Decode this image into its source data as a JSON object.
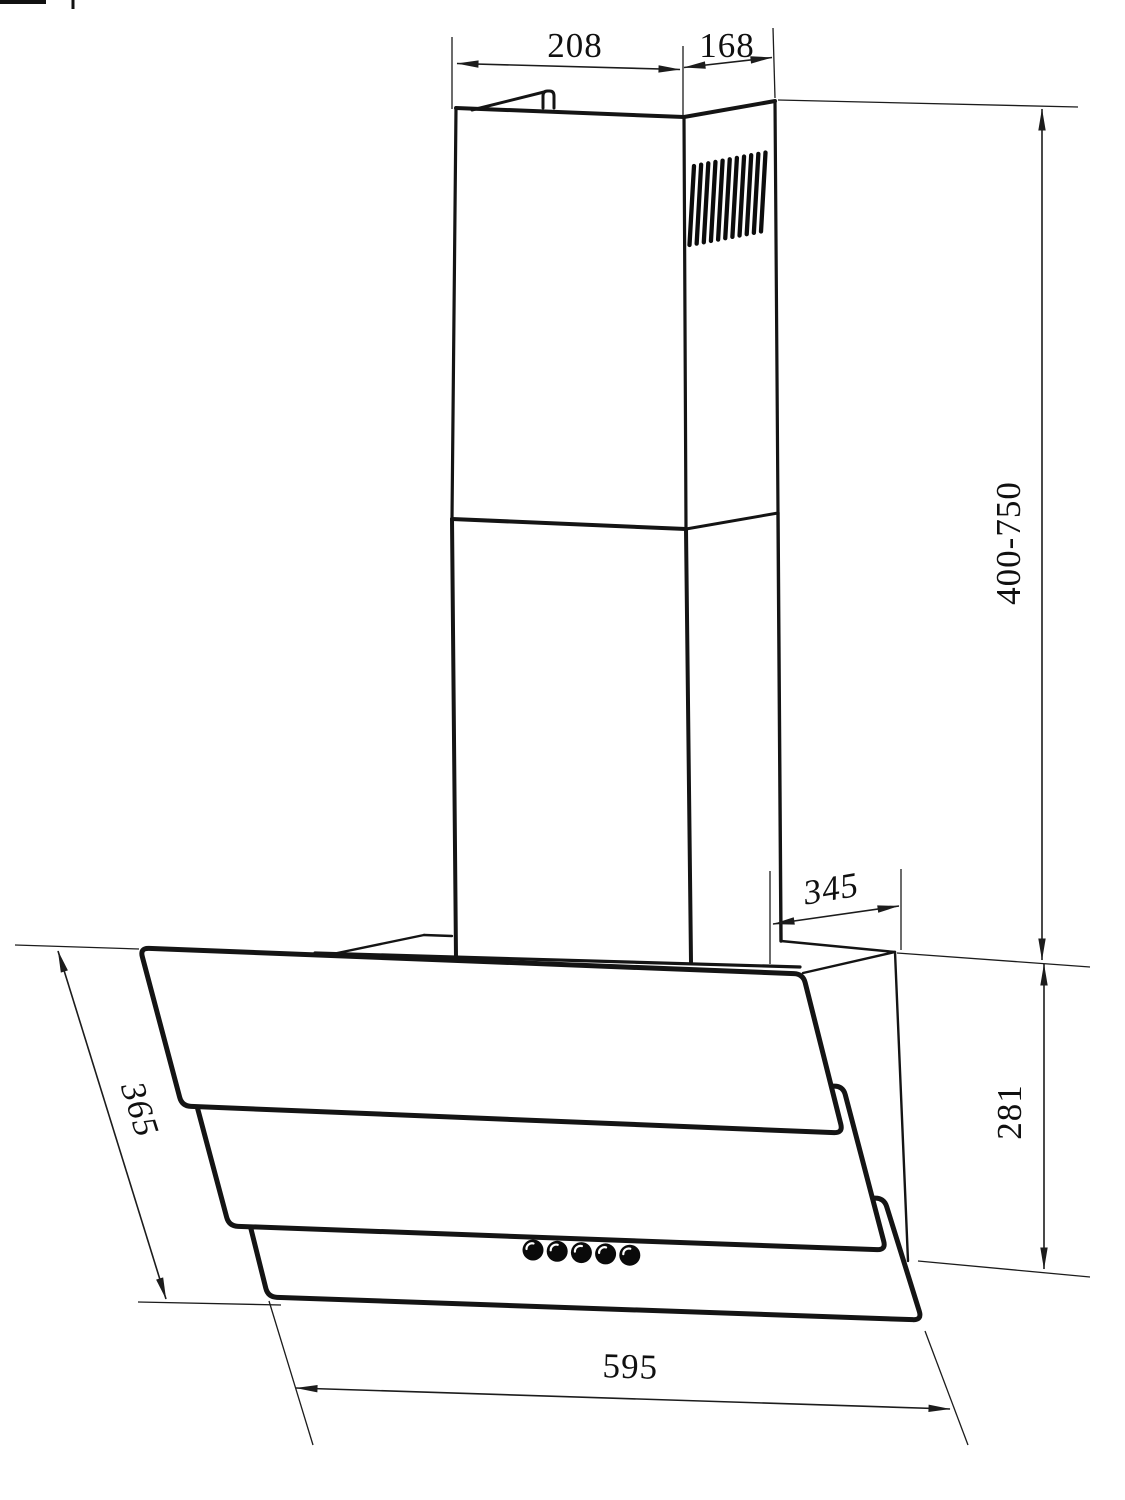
{
  "page": {
    "background": "#ffffff",
    "line_color": "#141414"
  },
  "drawing": {
    "type": "technical dimension drawing",
    "subject": "angled wall-mounted cooker hood with telescopic chimney",
    "dimensions": {
      "chimney_front_width": "208",
      "chimney_side_depth": "168",
      "chimney_height_range": "400-750",
      "hood_top_depth": "345",
      "hood_right_height": "281",
      "glass_front_length": "365",
      "hood_bottom_width": "595"
    },
    "features": {
      "vent_slat_count": 11,
      "control_button_count": 5
    }
  }
}
